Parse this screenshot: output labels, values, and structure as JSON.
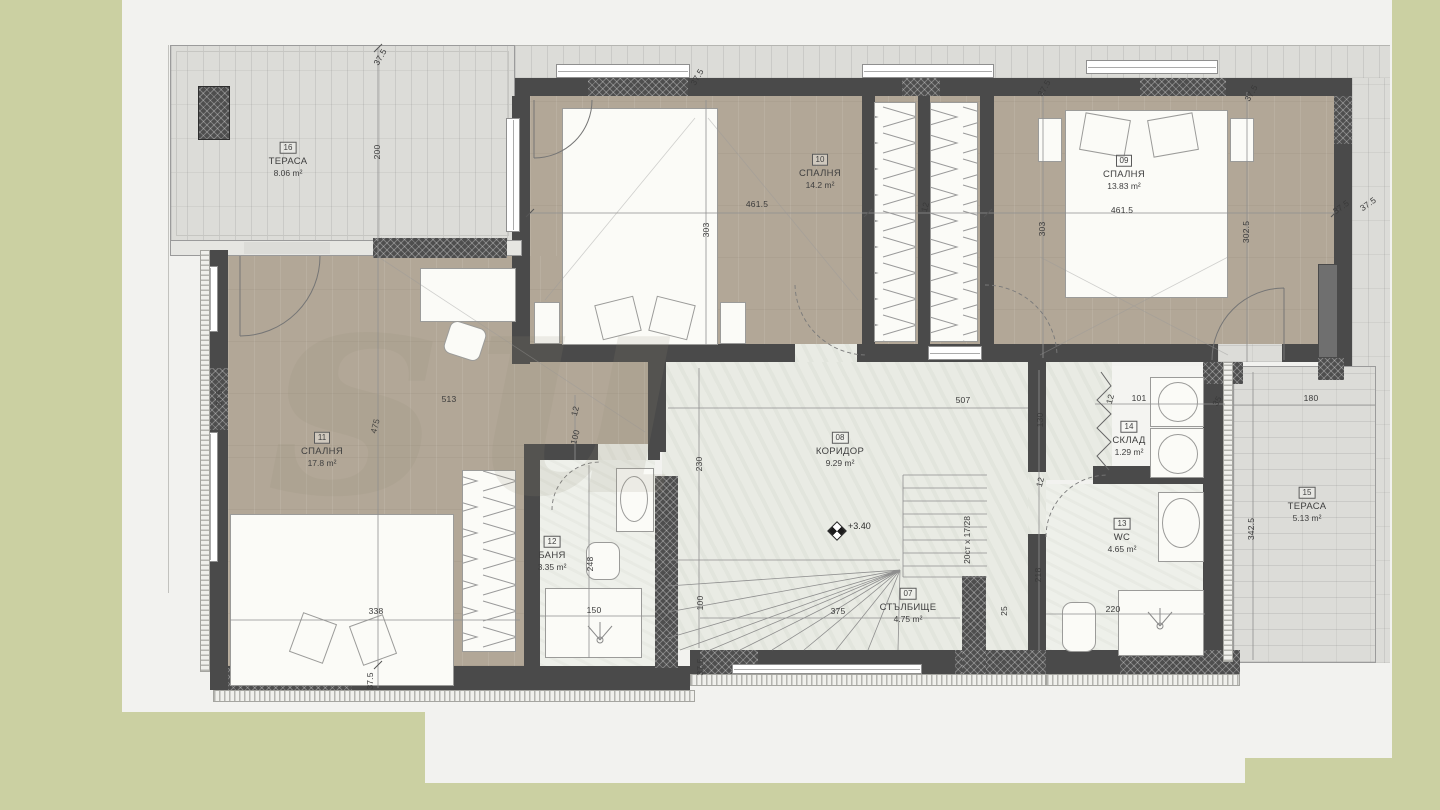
{
  "plan": {
    "title": "Floor plan — upper level",
    "level_mark": "+3.40",
    "stairs_note": "20ст x 17/28",
    "watermark": "su"
  },
  "colors": {
    "wall": "#4a4a4a",
    "wood_floor": "#b2a797",
    "tile_floor": "#dcdcd8",
    "hall_floor": "#e9ebe4",
    "paper": "#f2f2ef",
    "background_green": "#cbd0a2"
  },
  "rooms": [
    {
      "num": "16",
      "name": "ТЕРАСА",
      "area": "8.06 m²"
    },
    {
      "num": "10",
      "name": "СПАЛНЯ",
      "area": "14.2 m²"
    },
    {
      "num": "09",
      "name": "СПАЛНЯ",
      "area": "13.83 m²"
    },
    {
      "num": "11",
      "name": "СПАЛНЯ",
      "area": "17.8 m²"
    },
    {
      "num": "08",
      "name": "КОРИДОР",
      "area": "9.29 m²"
    },
    {
      "num": "12",
      "name": "БАНЯ",
      "area": "3.35 m²"
    },
    {
      "num": "07",
      "name": "СТЪЛБИЩЕ",
      "area": "4.75 m²"
    },
    {
      "num": "13",
      "name": "WC",
      "area": "4.65 m²"
    },
    {
      "num": "14",
      "name": "СКЛАД",
      "area": "1.29 m²"
    },
    {
      "num": "15",
      "name": "ТЕРАСА",
      "area": "5.13 m²"
    }
  ],
  "dimensions": [
    {
      "t": "37.5",
      "x": 380,
      "y": 57,
      "r": -60
    },
    {
      "t": "200",
      "x": 377,
      "y": 152,
      "r": -90
    },
    {
      "t": "37.5",
      "x": 697,
      "y": 77,
      "r": -60
    },
    {
      "t": "461.5",
      "x": 757,
      "y": 204,
      "r": 0
    },
    {
      "t": "303",
      "x": 706,
      "y": 230,
      "r": -90
    },
    {
      "t": "12",
      "x": 925,
      "y": 207,
      "r": -75
    },
    {
      "t": "461.5",
      "x": 1122,
      "y": 210,
      "r": 0
    },
    {
      "t": "303",
      "x": 1042,
      "y": 229,
      "r": -90
    },
    {
      "t": "302.5",
      "x": 1246,
      "y": 232,
      "r": -90
    },
    {
      "t": "37.5",
      "x": 1341,
      "y": 207,
      "r": -35
    },
    {
      "t": "37.5",
      "x": 1368,
      "y": 204,
      "r": -35
    },
    {
      "t": "37.5",
      "x": 1044,
      "y": 88,
      "r": -60
    },
    {
      "t": "37.5",
      "x": 1251,
      "y": 93,
      "r": -60
    },
    {
      "t": "513",
      "x": 449,
      "y": 399,
      "r": 0
    },
    {
      "t": "475",
      "x": 375,
      "y": 426,
      "r": -75
    },
    {
      "t": "37.5",
      "x": 219,
      "y": 398,
      "r": -90
    },
    {
      "t": "338",
      "x": 376,
      "y": 611,
      "r": 0
    },
    {
      "t": "37.5",
      "x": 370,
      "y": 681,
      "r": -90
    },
    {
      "t": "12",
      "x": 575,
      "y": 411,
      "r": -75
    },
    {
      "t": "100",
      "x": 575,
      "y": 437,
      "r": -75
    },
    {
      "t": "248",
      "x": 590,
      "y": 564,
      "r": -90
    },
    {
      "t": "150",
      "x": 594,
      "y": 610,
      "r": 0
    },
    {
      "t": "230",
      "x": 699,
      "y": 464,
      "r": -90
    },
    {
      "t": "100",
      "x": 700,
      "y": 603,
      "r": -90
    },
    {
      "t": "37.5",
      "x": 700,
      "y": 667,
      "r": -90
    },
    {
      "t": "375",
      "x": 838,
      "y": 611,
      "r": 0
    },
    {
      "t": "25",
      "x": 1004,
      "y": 611,
      "r": -90
    },
    {
      "t": "507",
      "x": 963,
      "y": 400,
      "r": 0
    },
    {
      "t": "130",
      "x": 1040,
      "y": 420,
      "r": -90
    },
    {
      "t": "12",
      "x": 1040,
      "y": 482,
      "r": -75
    },
    {
      "t": "218",
      "x": 1038,
      "y": 575,
      "r": -90
    },
    {
      "t": "220",
      "x": 1113,
      "y": 609,
      "r": 0
    },
    {
      "t": "12",
      "x": 1110,
      "y": 399,
      "r": -75
    },
    {
      "t": "101",
      "x": 1139,
      "y": 398,
      "r": 0
    },
    {
      "t": "35",
      "x": 1217,
      "y": 401,
      "r": -60
    },
    {
      "t": "342.5",
      "x": 1251,
      "y": 529,
      "r": -90
    },
    {
      "t": "180",
      "x": 1311,
      "y": 398,
      "r": 0
    }
  ]
}
